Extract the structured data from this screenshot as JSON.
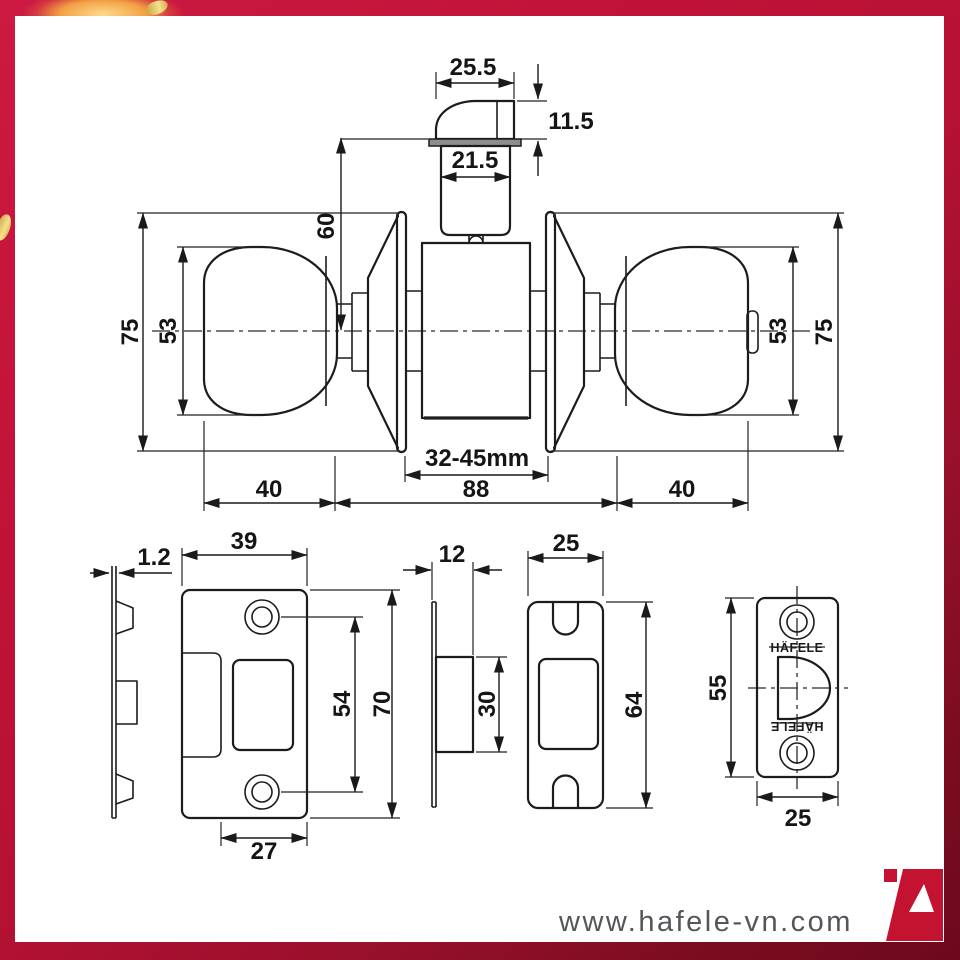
{
  "frame": {
    "color": "#c01238",
    "dark_color": "#6d091b",
    "gold_color": "#f6e08d"
  },
  "drawing": {
    "latch": {
      "top_width": "25.5",
      "bolt_height": "11.5",
      "body_width": "21.5",
      "center_to_face": "60"
    },
    "assembly": {
      "rose_left": "75",
      "knob_left": "53",
      "knob_right": "53",
      "rose_right": "75",
      "knob_depth_left": "40",
      "body_width": "88",
      "knob_depth_right": "40",
      "door_thickness_range": "32-45mm"
    },
    "strike_plate": {
      "thickness": "1.2",
      "width": "39",
      "height": "70",
      "hole_spacing": "54",
      "lip_width": "27"
    },
    "latch_case": {
      "depth": "12",
      "height": "30"
    },
    "dust_box": {
      "width": "25",
      "height": "64"
    },
    "faceplate": {
      "height": "55",
      "width": "25",
      "brand": "HÄFELE"
    }
  },
  "footer": {
    "website": "www.hafele-vn.com"
  },
  "logo": {
    "name": "hafele-a-logo",
    "color": "#c31330"
  }
}
